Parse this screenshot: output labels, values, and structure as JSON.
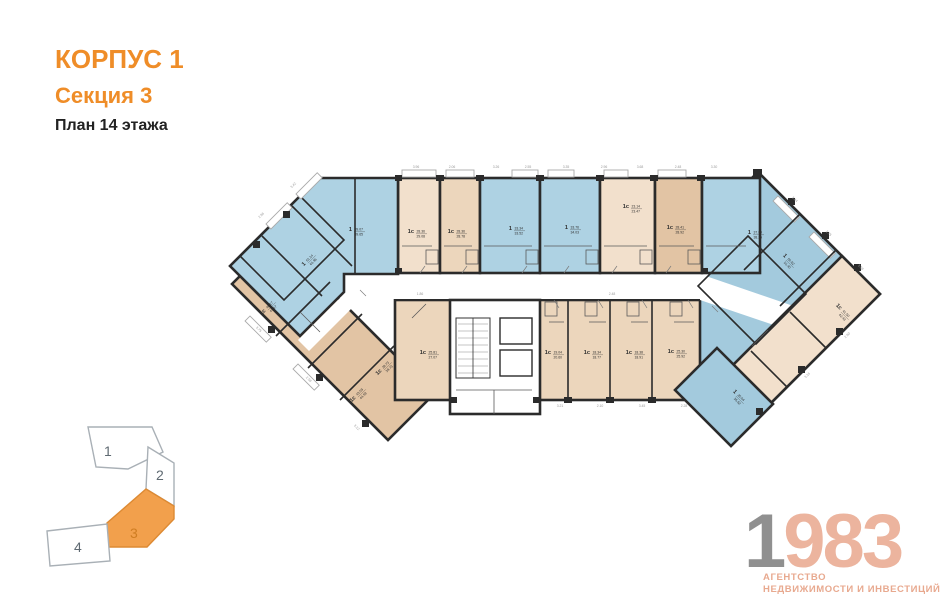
{
  "header": {
    "building": "КОРПУС 1",
    "section": "Секция 3",
    "floor": "План 14 этажа"
  },
  "palette": {
    "accent_orange": "#ef8d28",
    "minimap_orange": "#f2a04c",
    "apartment_blue_light": "#aed2e3",
    "apartment_blue_dark": "#8abbd1",
    "apartment_beige_light": "#f2e0cc",
    "apartment_beige_dark": "#e2c4a4",
    "wall_black": "#2b2b2b",
    "logo_gray": "#909090",
    "logo_salmon": "#ecb49e"
  },
  "plan": {
    "apartments": [
      {
        "type": "1",
        "a1": "39.07",
        "a2": "39.65",
        "x": 352,
        "y": 231,
        "rot": 0
      },
      {
        "type": "1",
        "a1": "61.14",
        "a2": "61.96",
        "x": 306,
        "y": 264,
        "rot": -45
      },
      {
        "type": "1с",
        "a1": "28.36",
        "a2": "29.08",
        "x": 414,
        "y": 233,
        "rot": 0
      },
      {
        "type": "1с",
        "a1": "28.36",
        "a2": "28.78",
        "x": 454,
        "y": 233,
        "rot": 0
      },
      {
        "type": "1",
        "a1": "33.34",
        "a2": "33.52",
        "x": 512,
        "y": 230,
        "rot": 0
      },
      {
        "type": "1",
        "a1": "33.76",
        "a2": "34.03",
        "x": 568,
        "y": 229,
        "rot": 0
      },
      {
        "type": "1с",
        "a1": "23.14",
        "a2": "23.47",
        "x": 629,
        "y": 208,
        "rot": 0
      },
      {
        "type": "1с",
        "a1": "28.41",
        "a2": "28.92",
        "x": 673,
        "y": 229,
        "rot": 0
      },
      {
        "type": "1",
        "a1": "37.80",
        "a2": "38.25",
        "x": 751,
        "y": 234,
        "rot": 0
      },
      {
        "type": "1",
        "a1": "50.62",
        "a2": "51.40",
        "x": 785,
        "y": 258,
        "rot": 45
      },
      {
        "type": "1с",
        "a1": "40.17",
        "a2": "41.17",
        "x": 266,
        "y": 311,
        "rot": -45
      },
      {
        "type": "1с",
        "a1": "38.73",
        "a2": "39.73",
        "x": 382,
        "y": 371,
        "rot": -45
      },
      {
        "type": "1с",
        "a1": "43.59",
        "a2": "44.59",
        "x": 356,
        "y": 398,
        "rot": -45
      },
      {
        "type": "1с",
        "a1": "25.81",
        "a2": "27.07",
        "x": 426,
        "y": 354,
        "rot": 0
      },
      {
        "type": "1с",
        "a1": "19.04",
        "a2": "20.60",
        "x": 551,
        "y": 354,
        "rot": 0
      },
      {
        "type": "1с",
        "a1": "18.34",
        "a2": "18.77",
        "x": 590,
        "y": 354,
        "rot": 0
      },
      {
        "type": "1с",
        "a1": "18.38",
        "a2": "18.91",
        "x": 632,
        "y": 354,
        "rot": 0
      },
      {
        "type": "1с",
        "a1": "25.30",
        "a2": "25.92",
        "x": 674,
        "y": 353,
        "rot": 0
      },
      {
        "type": "1с",
        "a1": "41.50",
        "a2": "42.43",
        "x": 840,
        "y": 310,
        "rot": 45
      },
      {
        "type": "1",
        "a1": "35.04",
        "a2": "35.62",
        "x": 735,
        "y": 394,
        "rot": 45
      }
    ],
    "dimensions": [
      {
        "t": "3.96",
        "x": 416,
        "y": 168,
        "r": 0
      },
      {
        "t": "2.06",
        "x": 452,
        "y": 168,
        "r": 0
      },
      {
        "t": "3.26",
        "x": 496,
        "y": 168,
        "r": 0
      },
      {
        "t": "2.55",
        "x": 528,
        "y": 168,
        "r": 0
      },
      {
        "t": "3.35",
        "x": 566,
        "y": 168,
        "r": 0
      },
      {
        "t": "2.96",
        "x": 604,
        "y": 168,
        "r": 0
      },
      {
        "t": "3.68",
        "x": 640,
        "y": 168,
        "r": 0
      },
      {
        "t": "2.48",
        "x": 678,
        "y": 168,
        "r": 0
      },
      {
        "t": "3.30",
        "x": 714,
        "y": 168,
        "r": 0
      },
      {
        "t": "3.21",
        "x": 560,
        "y": 407,
        "r": 0
      },
      {
        "t": "2.10",
        "x": 600,
        "y": 407,
        "r": 0
      },
      {
        "t": "3.45",
        "x": 642,
        "y": 407,
        "r": 0
      },
      {
        "t": "2.28",
        "x": 684,
        "y": 407,
        "r": 0
      },
      {
        "t": "2.96",
        "x": 262,
        "y": 216,
        "r": -45
      },
      {
        "t": "3.42",
        "x": 294,
        "y": 186,
        "r": -45
      },
      {
        "t": "3.75",
        "x": 258,
        "y": 330,
        "r": 45
      },
      {
        "t": "2.58",
        "x": 308,
        "y": 380,
        "r": 45
      },
      {
        "t": "3.12",
        "x": 356,
        "y": 428,
        "r": 45
      },
      {
        "t": "3.44",
        "x": 794,
        "y": 200,
        "r": 45
      },
      {
        "t": "2.75",
        "x": 828,
        "y": 234,
        "r": 45
      },
      {
        "t": "3.58",
        "x": 860,
        "y": 268,
        "r": 45
      },
      {
        "t": "2.90",
        "x": 848,
        "y": 336,
        "r": -45
      },
      {
        "t": "3.16",
        "x": 808,
        "y": 376,
        "r": -45
      },
      {
        "t": "1.86",
        "x": 420,
        "y": 295,
        "r": 0
      },
      {
        "t": "2.48",
        "x": 612,
        "y": 295,
        "r": 0
      }
    ]
  },
  "minimap": {
    "sections": [
      {
        "label": "1",
        "active": false
      },
      {
        "label": "2",
        "active": false
      },
      {
        "label": "3",
        "active": true
      },
      {
        "label": "4",
        "active": false
      }
    ]
  },
  "logo": {
    "year_first": "1",
    "year_rest": "983",
    "line1": "АГЕНТСТВО",
    "line2": "НЕДВИЖИМОСТИ И ИНВЕСТИЦИЙ"
  }
}
